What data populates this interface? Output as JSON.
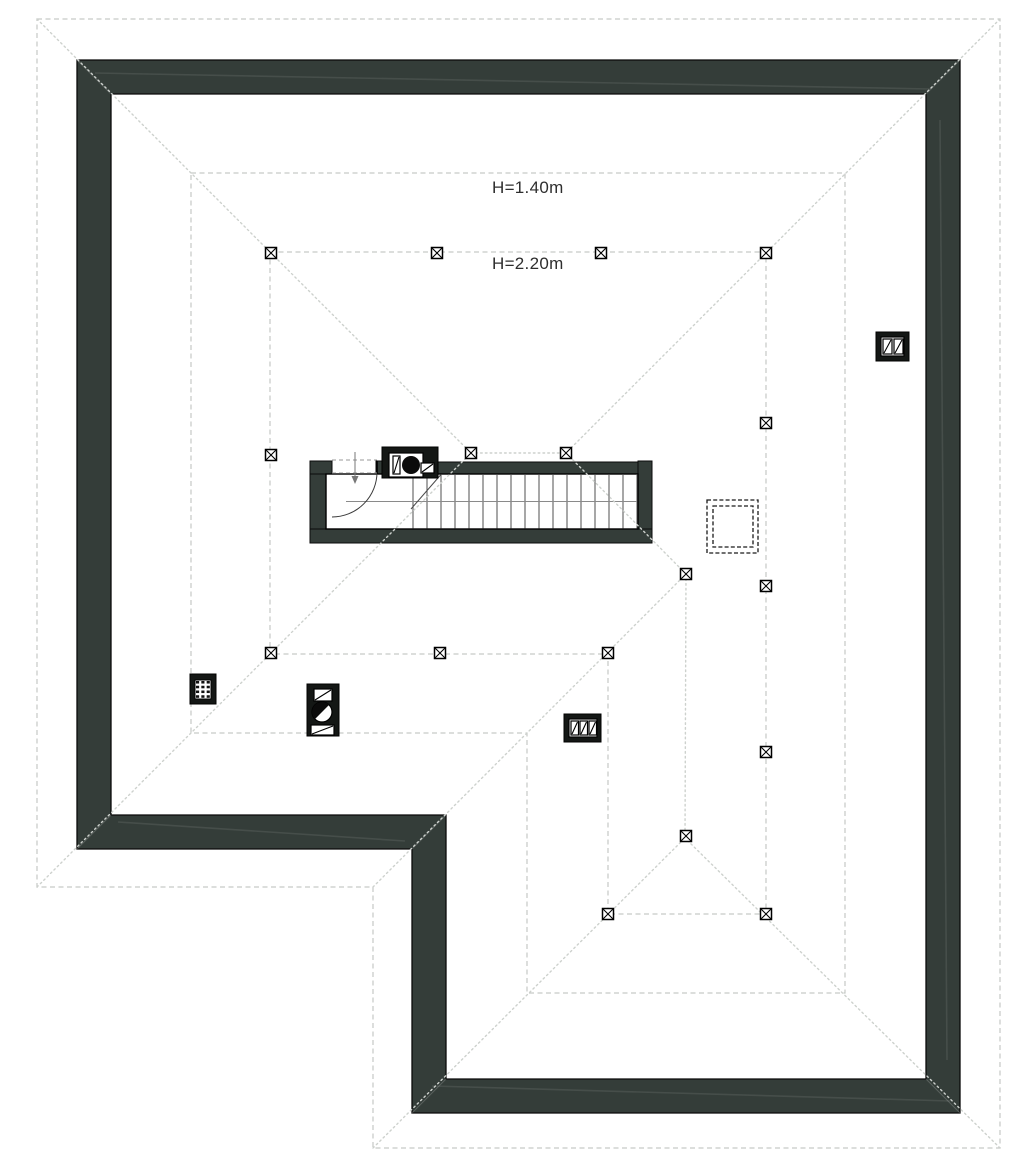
{
  "labels": {
    "h140": {
      "text": "H=1.40m"
    },
    "h220": {
      "text": "H=2.20m"
    }
  },
  "colors": {
    "background": "#ffffff",
    "wall_fill": "#343d39",
    "wall_edge": "#0a0a0a",
    "dash_light": "#c6c9c6",
    "dash_dot": "#cdd1cd",
    "hatch_dark": "#1a1a1a",
    "symbol_black": "#141715",
    "tread": "#3c3c3c",
    "walkline": "#8a8a8a",
    "door": "#3a3a3a",
    "door_dash": "#9a9a9a"
  },
  "plan": {
    "size": [
      1021,
      1167
    ],
    "walls": {
      "outer": [
        [
          77,
          60
        ],
        [
          960,
          60
        ],
        [
          960,
          1113
        ],
        [
          412,
          1113
        ],
        [
          412,
          849
        ],
        [
          77,
          849
        ]
      ],
      "inner": [
        [
          111,
          94
        ],
        [
          926,
          94
        ],
        [
          926,
          1079
        ],
        [
          446,
          1079
        ],
        [
          446,
          815
        ],
        [
          111,
          815
        ]
      ]
    },
    "wall_miters": [
      [
        [
          77,
          60
        ],
        [
          111,
          94
        ]
      ],
      [
        [
          960,
          60
        ],
        [
          926,
          94
        ]
      ],
      [
        [
          960,
          1113
        ],
        [
          926,
          1079
        ]
      ],
      [
        [
          412,
          1113
        ],
        [
          446,
          1079
        ]
      ],
      [
        [
          77,
          849
        ],
        [
          111,
          815
        ]
      ],
      [
        [
          412,
          849
        ],
        [
          446,
          815
        ]
      ]
    ],
    "wall_streaks": [
      [
        [
          95,
          73
        ],
        [
          930,
          89
        ]
      ],
      [
        [
          118,
          822
        ],
        [
          405,
          841
        ]
      ],
      [
        [
          432,
          1086
        ],
        [
          950,
          1101
        ]
      ],
      [
        [
          940,
          120
        ],
        [
          947,
          1060
        ]
      ]
    ],
    "eave_outline": [
      [
        37,
        19
      ],
      [
        1000,
        19
      ],
      [
        1000,
        1148
      ],
      [
        373,
        1148
      ],
      [
        373,
        887
      ],
      [
        37,
        887
      ]
    ],
    "roof_edges": [
      [
        [
          37,
          19
        ],
        [
          471,
          453
        ]
      ],
      [
        [
          1000,
          19
        ],
        [
          566,
          453
        ]
      ],
      [
        [
          471,
          453
        ],
        [
          566,
          453
        ]
      ],
      [
        [
          37,
          887
        ],
        [
          471,
          453
        ]
      ],
      [
        [
          373,
          887
        ],
        [
          686,
          574
        ]
      ],
      [
        [
          566,
          453
        ],
        [
          686,
          574
        ]
      ],
      [
        [
          686,
          574
        ],
        [
          685,
          838
        ]
      ],
      [
        [
          373,
          1148
        ],
        [
          685,
          838
        ]
      ],
      [
        [
          1000,
          1148
        ],
        [
          685,
          838
        ]
      ]
    ],
    "contour_h140": [
      [
        191,
        173
      ],
      [
        845,
        173
      ],
      [
        845,
        993
      ],
      [
        527,
        993
      ],
      [
        527,
        733
      ],
      [
        191,
        733
      ]
    ],
    "contour_h220": [
      [
        270,
        252
      ],
      [
        766,
        252
      ],
      [
        766,
        914
      ],
      [
        608,
        914
      ],
      [
        608,
        654
      ],
      [
        270,
        654
      ]
    ],
    "posts": [
      [
        271,
        253
      ],
      [
        437,
        253
      ],
      [
        601,
        253
      ],
      [
        766,
        253
      ],
      [
        271,
        455
      ],
      [
        271,
        653
      ],
      [
        766,
        423
      ],
      [
        766,
        586
      ],
      [
        766,
        752
      ],
      [
        766,
        914
      ],
      [
        440,
        653
      ],
      [
        608,
        653
      ],
      [
        608,
        914
      ],
      [
        686,
        836
      ],
      [
        686,
        574
      ],
      [
        471,
        453
      ],
      [
        566,
        453
      ]
    ],
    "post_size": 11,
    "roof_hatch": {
      "outer": [
        707,
        500,
        51,
        53
      ],
      "inner": [
        713,
        506,
        40,
        41
      ]
    },
    "stair": {
      "wall_rects": [
        [
          310,
          461,
          16,
          82
        ],
        [
          310,
          461,
          22,
          13
        ],
        [
          436,
          462,
          216,
          12
        ],
        [
          638,
          461,
          14,
          82
        ],
        [
          310,
          529,
          342,
          14
        ],
        [
          376,
          461,
          7,
          13
        ]
      ],
      "cavity": [
        326,
        474,
        312,
        55
      ],
      "treads": {
        "from": 413,
        "to": 637,
        "step": 14,
        "y1": 475,
        "y2": 528.5
      },
      "walk_line": [
        [
          346,
          501.5
        ],
        [
          637,
          501.5
        ]
      ],
      "break_line": [
        [
          441,
          474.5
        ],
        [
          411,
          509
        ]
      ],
      "door": {
        "arc_start": [
          377,
          472
        ],
        "arc_end": [
          332,
          517
        ],
        "radius": 45,
        "jamb": [
          [
            377,
            460.5
          ],
          [
            377,
            474
          ]
        ]
      },
      "door_dashes": [
        [
          [
            332,
            460
          ],
          [
            377,
            460
          ]
        ],
        [
          [
            332,
            473
          ],
          [
            377,
            473
          ]
        ]
      ],
      "arrow": {
        "line": [
          [
            355,
            452
          ],
          [
            355,
            478
          ]
        ],
        "head": [
          [
            351.5,
            476
          ],
          [
            358.5,
            476
          ],
          [
            355,
            484
          ]
        ]
      }
    },
    "chimneys": [
      {
        "name": "stair-flue-block",
        "box": [
          382,
          447,
          56,
          31
        ],
        "parts": [
          {
            "kind": "rect",
            "r": [
              389,
              453,
              34,
              24
            ]
          },
          {
            "kind": "drect",
            "r": [
              393,
              456,
              7,
              18
            ]
          },
          {
            "kind": "dot",
            "c": [
              411,
              465
            ],
            "rad": 9
          },
          {
            "kind": "drect",
            "r": [
              421,
              463,
              13,
              10
            ]
          }
        ]
      },
      {
        "name": "vent-grid-block",
        "box": [
          190,
          674,
          26,
          30
        ],
        "parts": [
          {
            "kind": "grid",
            "r": [
              195,
              680,
              16,
              19
            ],
            "rows": 4,
            "cols": 3
          }
        ]
      },
      {
        "name": "fan-flue-block",
        "box": [
          307,
          684,
          32,
          52
        ],
        "parts": [
          {
            "kind": "drect",
            "r": [
              314,
              689,
              18,
              12
            ]
          },
          {
            "kind": "half",
            "c": [
              322,
              712
            ],
            "rad": 10
          },
          {
            "kind": "drect",
            "r": [
              311,
              725,
              23,
              10
            ]
          }
        ]
      },
      {
        "name": "triple-flue-block",
        "box": [
          564,
          714,
          37,
          28
        ],
        "parts": [
          {
            "kind": "rect",
            "r": [
              569,
              719,
              28,
              18
            ]
          },
          {
            "kind": "drect",
            "r": [
              571,
              721,
              7.5,
              14
            ]
          },
          {
            "kind": "drect",
            "r": [
              580,
              721,
              7.5,
              14
            ]
          },
          {
            "kind": "drect",
            "r": [
              589,
              721,
              7.5,
              14
            ]
          }
        ]
      },
      {
        "name": "double-flue-block",
        "box": [
          876,
          332,
          33,
          29
        ],
        "parts": [
          {
            "kind": "rect",
            "r": [
              881,
              337,
              23,
              19
            ]
          },
          {
            "kind": "drect",
            "r": [
              883,
              339,
              9,
              15
            ]
          },
          {
            "kind": "drect",
            "r": [
              894,
              339,
              9,
              15
            ]
          }
        ]
      }
    ]
  }
}
